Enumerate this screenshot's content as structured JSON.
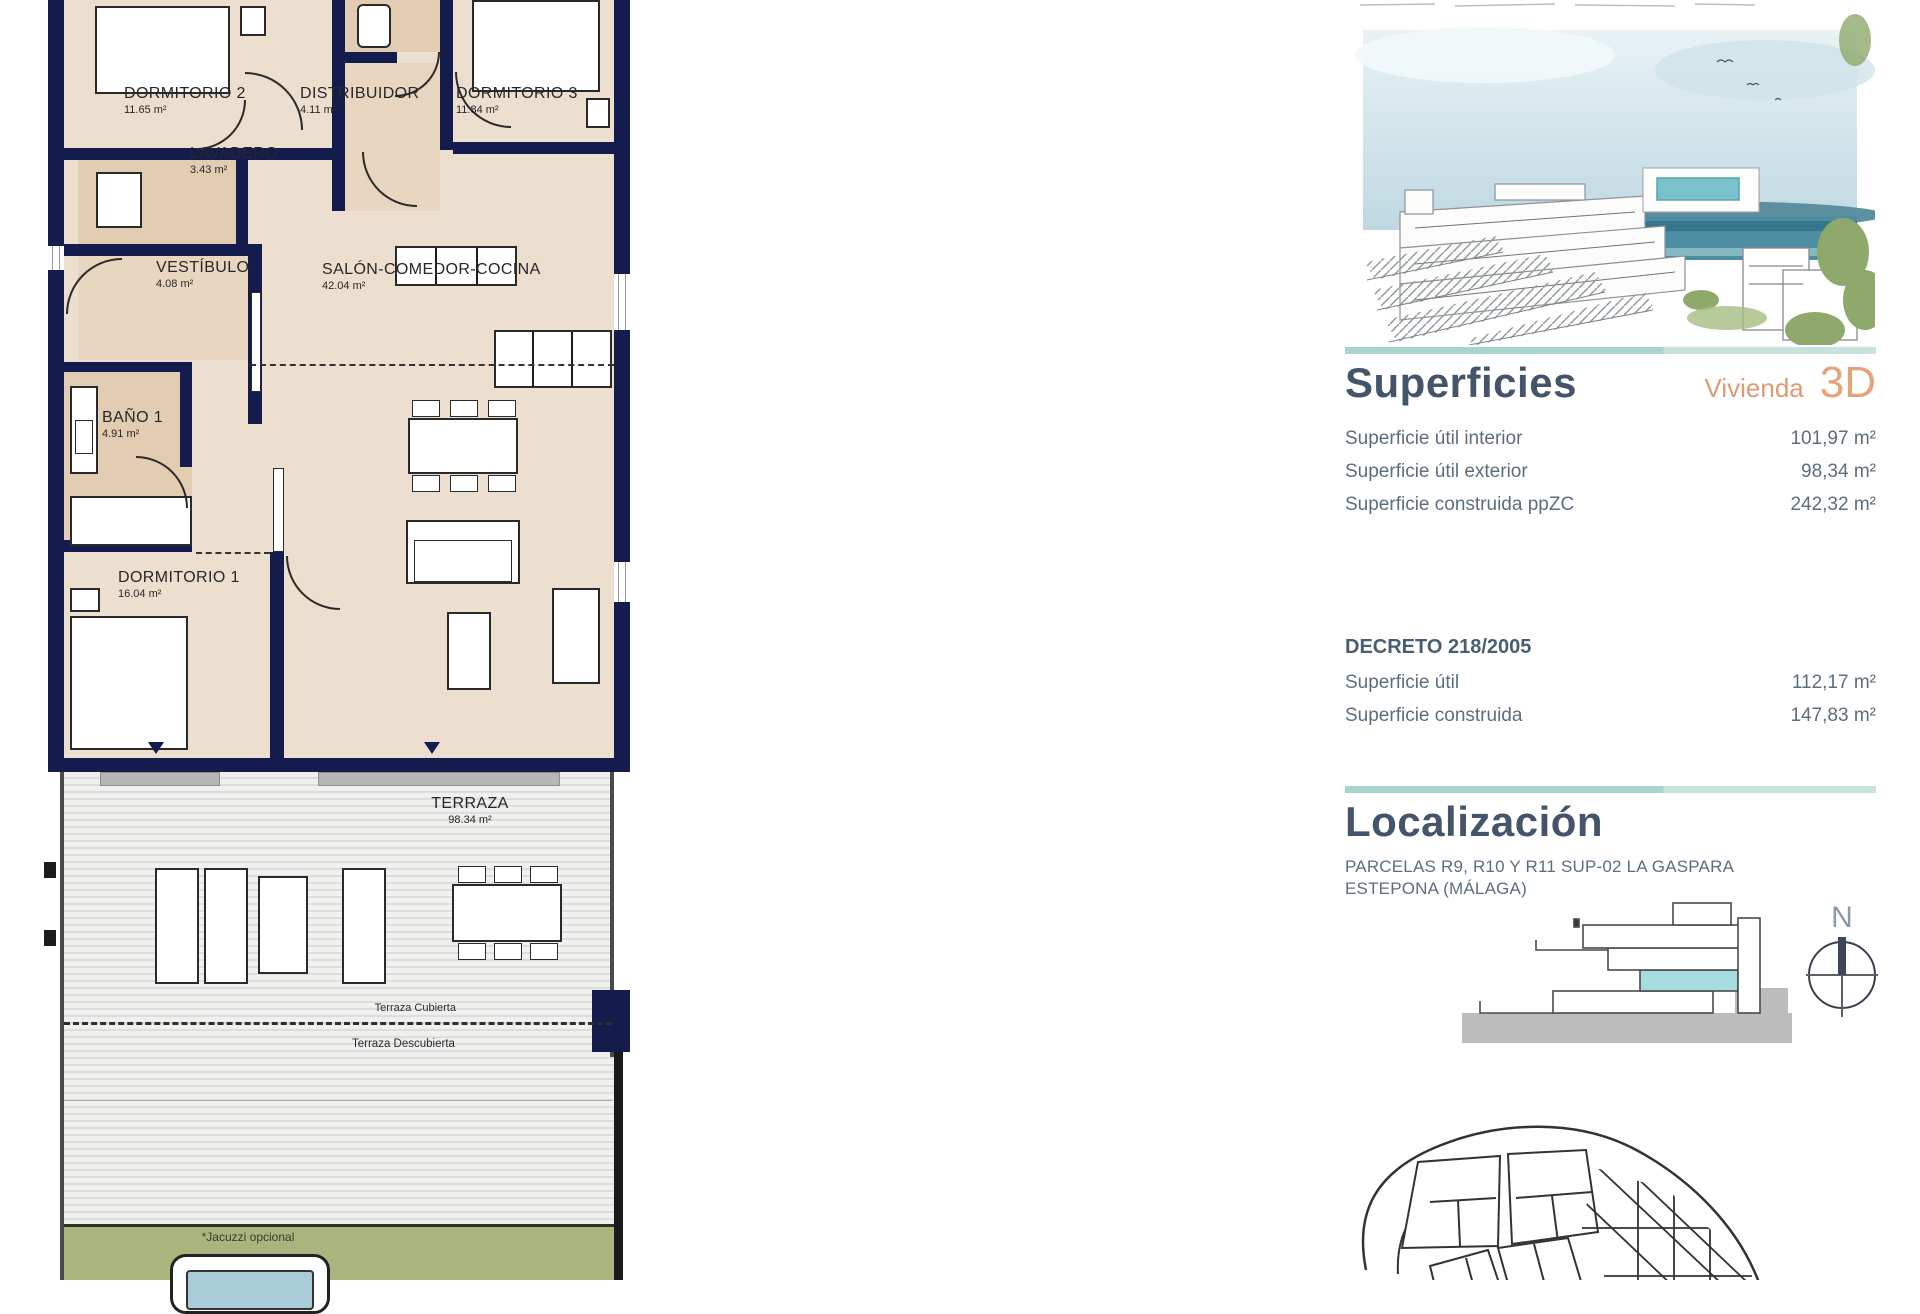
{
  "plan": {
    "rooms": [
      {
        "name": "DORMITORIO 2",
        "area": "11.65 m²"
      },
      {
        "name": "DISTRIBUIDOR",
        "area": "4.11 m²"
      },
      {
        "name": "DORMITORIO 3",
        "area": "11.84 m²"
      },
      {
        "name": "LAVADERO",
        "area": "3.43 m²"
      },
      {
        "name": "VESTÍBULO",
        "area": "4.08 m²"
      },
      {
        "name": "SALÓN-COMEDOR-COCINA",
        "area": "42.04 m²"
      },
      {
        "name": "BAÑO 1",
        "area": "4.91 m²"
      },
      {
        "name": "DORMITORIO 1",
        "area": "16.04 m²"
      },
      {
        "name": "TERRAZA",
        "area": "98.34 m²"
      }
    ],
    "terrace_covered_label": "Terraza Cubierta",
    "terrace_uncovered_label": "Terraza Descubierta",
    "jacuzzi_note": "*Jacuzzi opcional"
  },
  "info": {
    "superficies": {
      "title": "Superficies",
      "unit_label": "Vivienda",
      "unit_value": "3D",
      "rows": [
        {
          "label": "Superficie útil interior",
          "value": "101,97 m²"
        },
        {
          "label": "Superficie útil exterior",
          "value": "98,34 m²"
        },
        {
          "label": "Superficie construida ppZC",
          "value": "242,32 m²"
        }
      ]
    },
    "decreto": {
      "title": "DECRETO 218/2005",
      "rows": [
        {
          "label": "Superficie útil",
          "value": "112,17 m²"
        },
        {
          "label": "Superficie construida",
          "value": "147,83 m²"
        }
      ]
    },
    "localizacion": {
      "title": "Localización",
      "address_line1": "PARCELAS R9, R10 Y R11 SUP-02 LA GASPARA",
      "address_line2": "ESTEPONA (MÁLAGA)",
      "compass_label": "N"
    }
  },
  "colors": {
    "wall_navy": "#141c4e",
    "room_beige": "#ecdfcf",
    "room_tan": "#e2ccb2",
    "accent_teal_rule": "#a9d3cd",
    "accent_orange": "#e5a379",
    "heading_navy": "#44546a",
    "body_text": "#5b6e80",
    "highlight_teal": "#9fd8da",
    "garden_green": "#a8b67d",
    "jacuzzi_blue": "#a9ccd8"
  }
}
